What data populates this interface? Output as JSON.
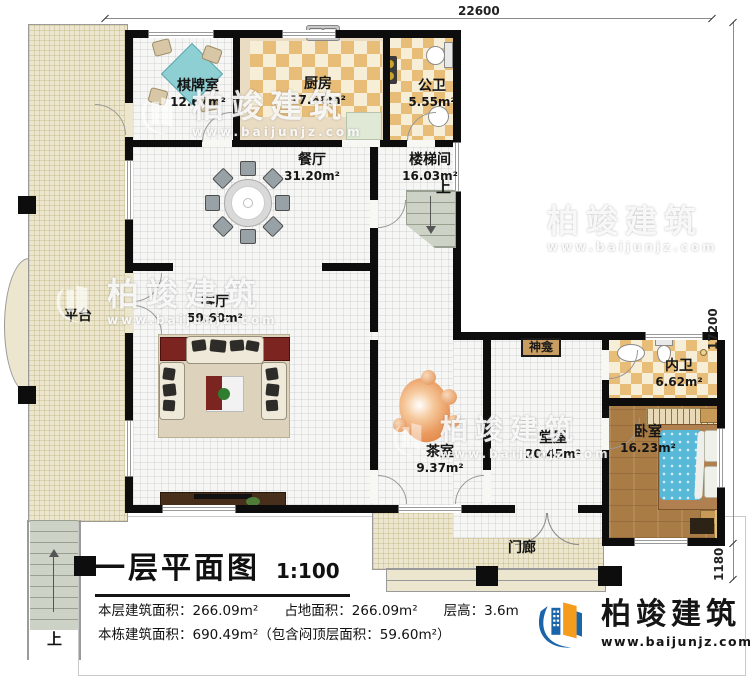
{
  "dimensions": {
    "top": "22600",
    "right": "17200",
    "bottom_right": "1180"
  },
  "rooms": {
    "qipai": {
      "name": "棋牌室",
      "area": "12.67m²"
    },
    "kitchen": {
      "name": "厨房",
      "area": "17.66m²"
    },
    "gongwei": {
      "name": "公卫",
      "area": "5.55m²"
    },
    "dining": {
      "name": "餐厅",
      "area": "31.20m²"
    },
    "stairhall": {
      "name": "楼梯间",
      "area": "16.03m²"
    },
    "terrace": {
      "name": "平台"
    },
    "living": {
      "name": "客厅",
      "area": "59.60m²"
    },
    "shrine": {
      "name": "神龛"
    },
    "neiwei": {
      "name": "内卫",
      "area": "6.62m²"
    },
    "tea": {
      "name": "茶室",
      "area": "9.37m²"
    },
    "hall": {
      "name": "堂屋",
      "area": "20.45m²"
    },
    "bedroom": {
      "name": "卧室",
      "area": "16.23m²"
    },
    "porch": {
      "name": "门廊"
    }
  },
  "stairs": {
    "up_label": "上"
  },
  "title_block": {
    "title": "一层平面图",
    "scale": "1:100",
    "line1_a": "本层建筑面积：266.09m²",
    "line1_b": "占地面积：266.09m²",
    "line1_c": "层高：3.6m",
    "line2": "本栋建筑面积：690.49m²（包含闷顶层面积：59.60m²）"
  },
  "branding": {
    "name": "柏竣建筑",
    "website": "www.baijunjz.com"
  },
  "watermark": {
    "name": "柏竣建筑",
    "website": "www.baijunjz.com"
  },
  "palette": {
    "brand_blue": "#1a64aa",
    "brand_orange": "#f59c1d",
    "wall_black": "#0d0d0d",
    "terrace_beige": "#ebe6cd",
    "checker_tan": "#e7bd78",
    "bed_blue": "#57b8d8",
    "wood_brown": "#a97c45",
    "shrine_tan": "#c89d62"
  }
}
